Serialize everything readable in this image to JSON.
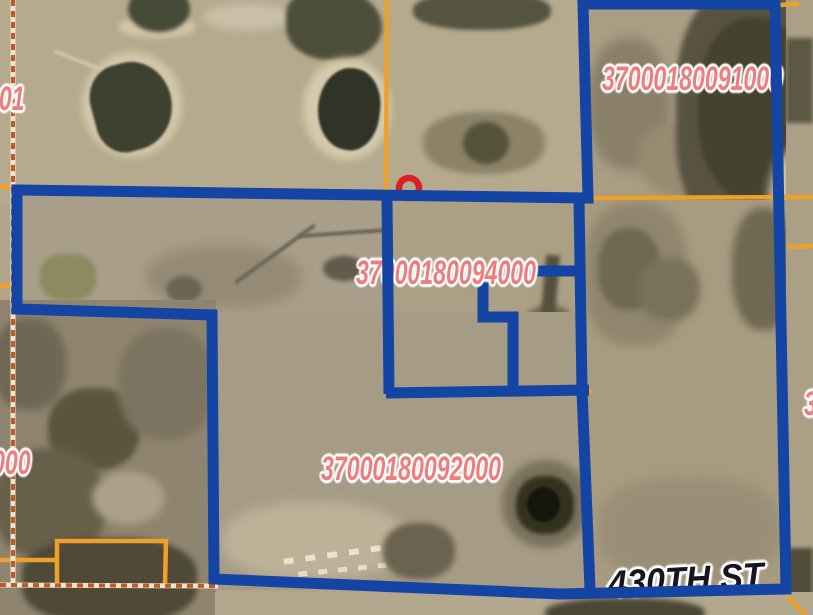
{
  "map": {
    "view": "aerial-imagery-with-parcel-overlay",
    "parcel_labels": [
      {
        "text": "001"
      },
      {
        "text": "37000180091000"
      },
      {
        "text": "37000180094000"
      },
      {
        "text": "37000180092000"
      },
      {
        "text": "000"
      },
      {
        "text": "3"
      }
    ],
    "road_label": {
      "text": "430TH ST"
    },
    "colors": {
      "selection_outline": "#1444a4",
      "parcel_line": "#eea02b",
      "section_dash": "#bf5a2b",
      "dash_base": "#f0e4cc",
      "parcel_label": "#ee7d7d",
      "road_label": "#16161f",
      "marker": "#da2020"
    }
  }
}
